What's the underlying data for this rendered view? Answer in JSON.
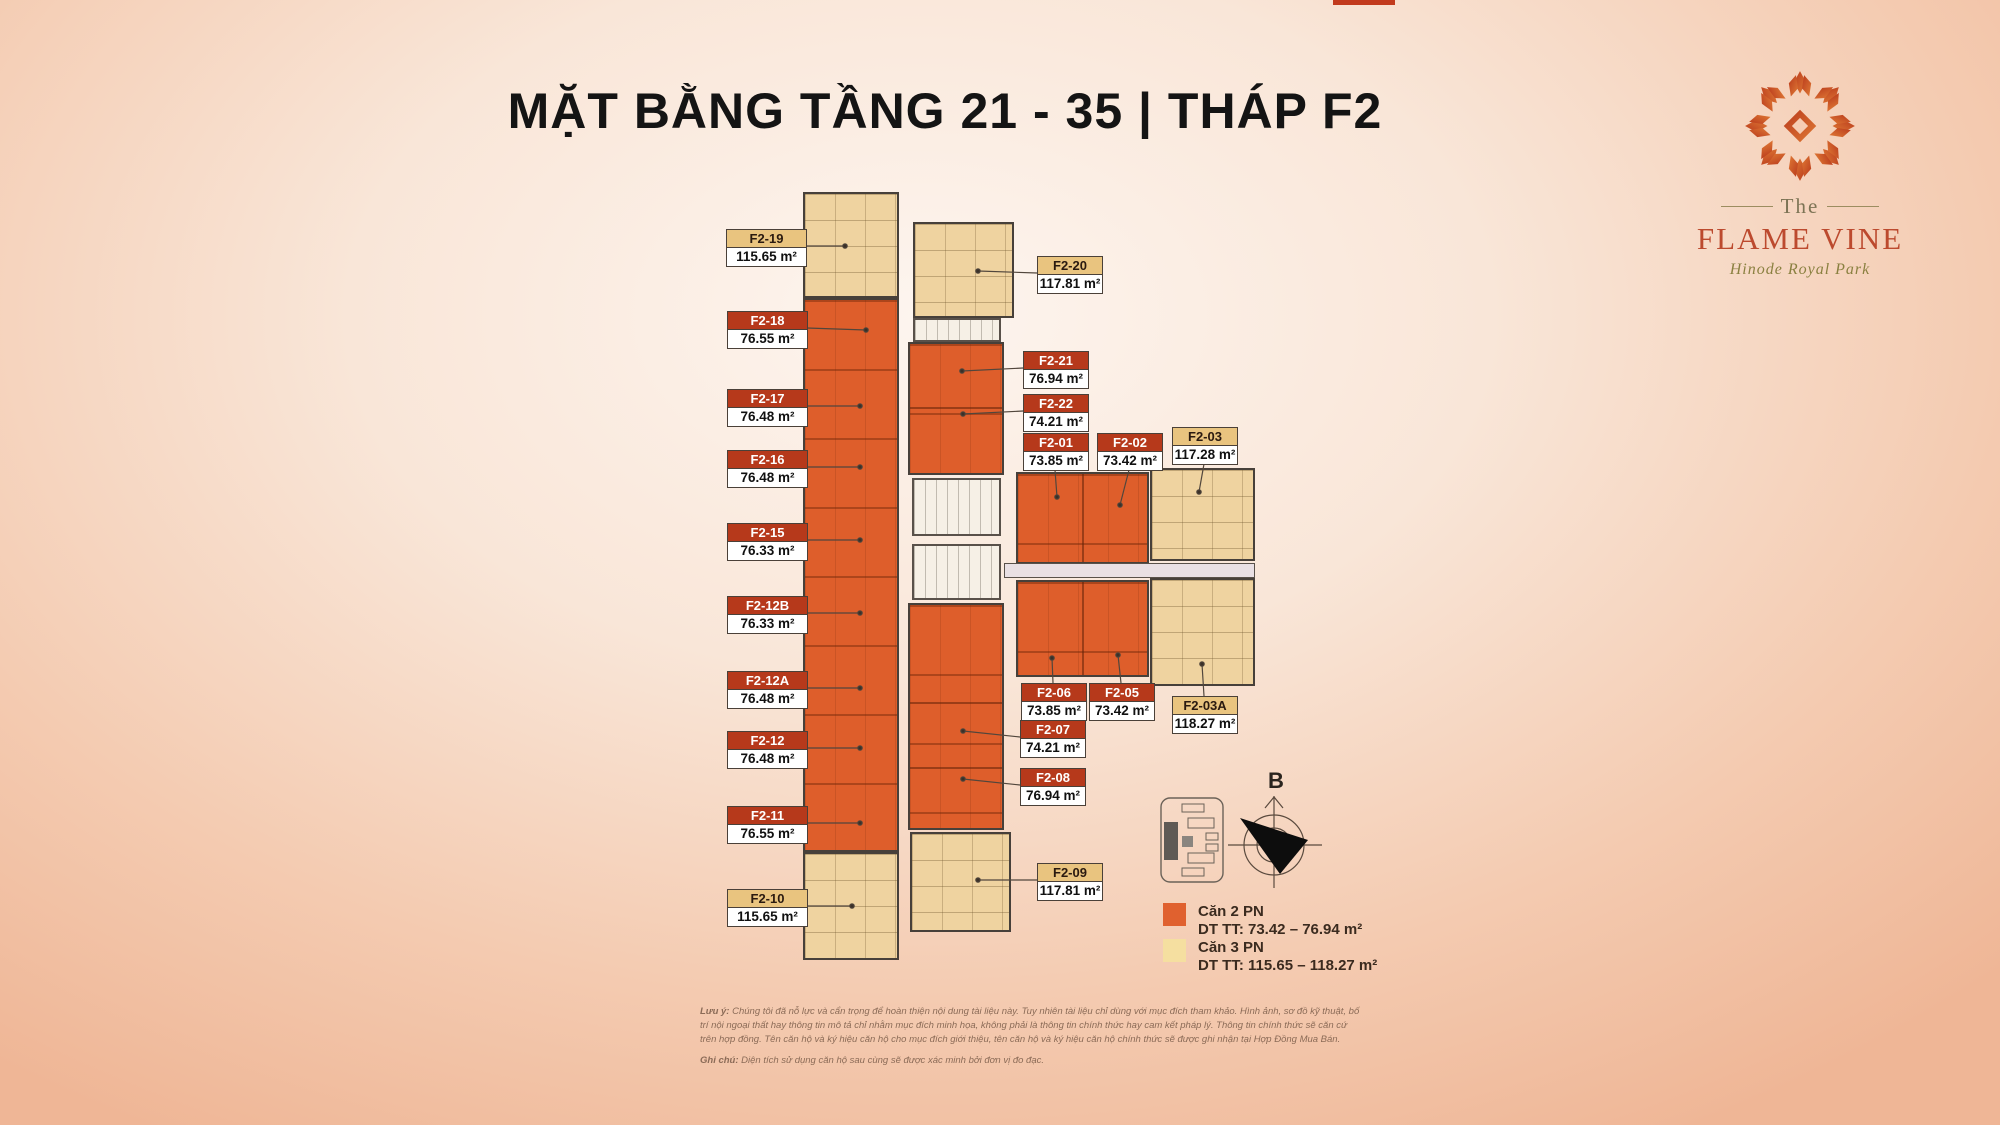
{
  "title": "MẶT BẰNG TẦNG 21 - 35 | THÁP F2",
  "logo": {
    "prefix": "The",
    "name": "FLAME VINE",
    "subtitle": "Hinode Royal Park"
  },
  "units": [
    {
      "code": "F2-19",
      "area": "115.65 m²",
      "type": "3PN"
    },
    {
      "code": "F2-18",
      "area": "76.55 m²",
      "type": "2PN"
    },
    {
      "code": "F2-17",
      "area": "76.48 m²",
      "type": "2PN"
    },
    {
      "code": "F2-16",
      "area": "76.48 m²",
      "type": "2PN"
    },
    {
      "code": "F2-15",
      "area": "76.33 m²",
      "type": "2PN"
    },
    {
      "code": "F2-12B",
      "area": "76.33 m²",
      "type": "2PN"
    },
    {
      "code": "F2-12A",
      "area": "76.48 m²",
      "type": "2PN"
    },
    {
      "code": "F2-12",
      "area": "76.48 m²",
      "type": "2PN"
    },
    {
      "code": "F2-11",
      "area": "76.55 m²",
      "type": "2PN"
    },
    {
      "code": "F2-10",
      "area": "115.65 m²",
      "type": "3PN"
    },
    {
      "code": "F2-20",
      "area": "117.81 m²",
      "type": "3PN"
    },
    {
      "code": "F2-21",
      "area": "76.94 m²",
      "type": "2PN"
    },
    {
      "code": "F2-22",
      "area": "74.21 m²",
      "type": "2PN"
    },
    {
      "code": "F2-01",
      "area": "73.85 m²",
      "type": "2PN"
    },
    {
      "code": "F2-02",
      "area": "73.42 m²",
      "type": "2PN"
    },
    {
      "code": "F2-03",
      "area": "117.28 m²",
      "type": "3PN"
    },
    {
      "code": "F2-06",
      "area": "73.85 m²",
      "type": "2PN"
    },
    {
      "code": "F2-05",
      "area": "73.42 m²",
      "type": "2PN"
    },
    {
      "code": "F2-03A",
      "area": "118.27 m²",
      "type": "3PN"
    },
    {
      "code": "F2-07",
      "area": "74.21 m²",
      "type": "2PN"
    },
    {
      "code": "F2-08",
      "area": "76.94 m²",
      "type": "2PN"
    },
    {
      "code": "F2-09",
      "area": "117.81 m²",
      "type": "3PN"
    }
  ],
  "legend": [
    {
      "name": "Căn 2 PN",
      "range": "DT TT: 73.42 – 76.94 m²",
      "color": "#E0612F"
    },
    {
      "name": "Căn 3 PN",
      "range": "DT TT: 115.65 – 118.27 m²",
      "color": "#F5DFA0"
    }
  ],
  "compass": {
    "north_label": "B"
  },
  "notes": [
    {
      "label": "Lưu ý:",
      "text": " Chúng tôi đã nỗ lực và cẩn trọng để hoàn thiện nội dung tài liệu này. Tuy nhiên tài liệu chỉ dùng với mục đích tham khảo. Hình ảnh, sơ đồ kỹ thuật, bố trí nội ngoại thất hay thông tin mô tả chỉ nhằm mục đích minh họa, không phải là thông tin chính thức hay cam kết pháp lý. Thông tin chính thức sẽ căn cứ trên hợp đồng. Tên căn hộ và ký hiệu căn hộ cho mục đích giới thiệu, tên căn hộ và ký hiệu căn hộ chính thức sẽ được ghi nhận tại Hợp Đồng Mua Bán."
    },
    {
      "label": "Ghi chú:",
      "text": " Diện tích sử dụng căn hộ sau cùng sẽ được xác minh bởi đơn vị đo đạc."
    }
  ],
  "colors": {
    "unit_2pn_fill": "#DE5E2B",
    "unit_3pn_fill": "#EFD3A0",
    "label_2pn_header": "#B6391B",
    "label_3pn_header": "#E9C47F",
    "background_center": "#FDF5EF",
    "background_edge": "#EFB696",
    "brand_red": "#BC4A2E"
  }
}
